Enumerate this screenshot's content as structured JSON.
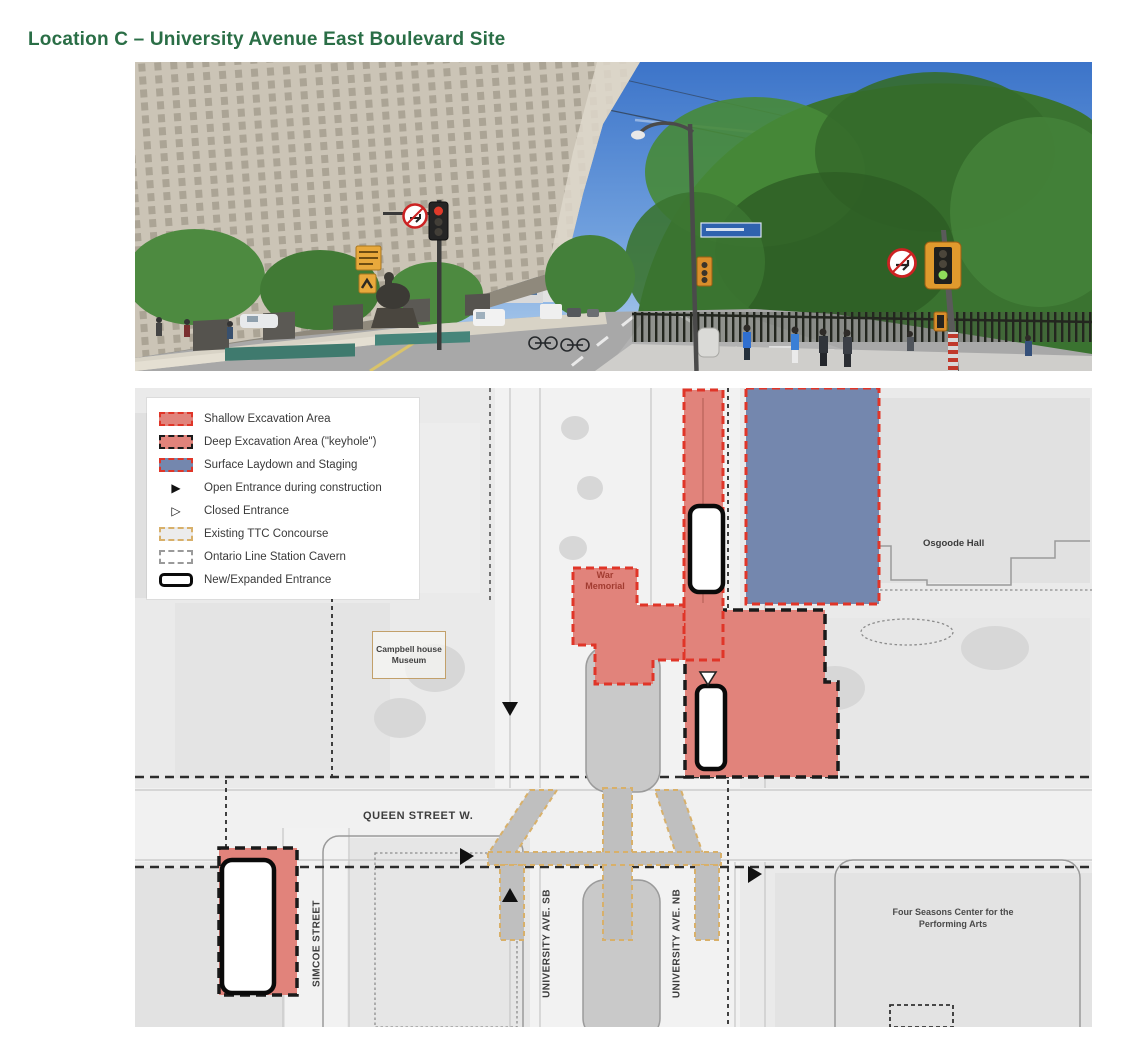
{
  "page": {
    "title": "Location C – University Avenue East Boulevard Site"
  },
  "legend": {
    "items": [
      {
        "label": "Shallow Excavation Area",
        "swatch": "shallow"
      },
      {
        "label": "Deep Excavation Area (\"keyhole\")",
        "swatch": "deep"
      },
      {
        "label": "Surface Laydown and Staging",
        "swatch": "staging"
      },
      {
        "label": "Open Entrance during construction",
        "swatch": "open-entrance",
        "glyph": "▶"
      },
      {
        "label": "Closed Entrance",
        "swatch": "closed-entrance",
        "glyph": "▷"
      },
      {
        "label": "Existing TTC Concourse",
        "swatch": "ttc"
      },
      {
        "label": "Ontario Line Station Cavern",
        "swatch": "cavern"
      },
      {
        "label": "New/Expanded Entrance",
        "swatch": "new-entrance"
      }
    ]
  },
  "map_labels": {
    "war_memorial": [
      "War",
      "Memorial"
    ],
    "osgoode_hall": "Osgoode Hall",
    "campbell_house": [
      "Campbell house",
      "Museum"
    ],
    "queen_street": "QUEEN STREET W.",
    "simcoe_street": "SIMCOE STREET",
    "university_sb": "UNIVERSITY AVE. SB",
    "university_nb": "UNIVERSITY AVE. NB",
    "four_seasons": [
      "Four Seasons Center for the",
      "Performing Arts"
    ]
  },
  "colors": {
    "heading_green": "#2a6e46",
    "shallow_fill": "#e1837b",
    "red_dash": "#e03528",
    "black_dash": "#1a1a1a",
    "staging_fill": "#7487ae",
    "ttc_tan": "#d8b06a",
    "map_bg": "#eaeaea",
    "label_gray": "#3f3f3f",
    "war_label_red": "#a23c31"
  }
}
